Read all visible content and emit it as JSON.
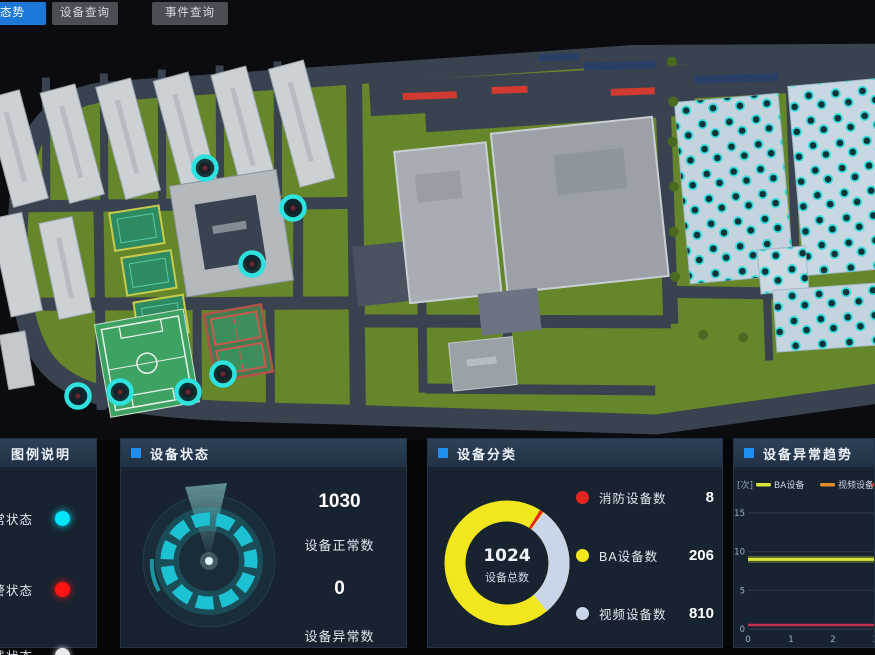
{
  "topbar": {
    "tabs": [
      {
        "label": "综合态势",
        "active": true
      },
      {
        "label": "设备查询",
        "active": false
      },
      {
        "label": "事件查询",
        "active": false
      }
    ]
  },
  "legend_panel": {
    "title": "图例说明",
    "items": [
      {
        "label": "正常状态",
        "color": "#00e6ff"
      },
      {
        "label": "报警状态",
        "color": "#ff1414"
      },
      {
        "label": "离线状态",
        "color": "#e9e9f0"
      }
    ]
  },
  "status_panel": {
    "title": "设备状态",
    "normal_value": "1030",
    "normal_label": "设备正常数",
    "abnormal_value": "0",
    "abnormal_label": "设备异常数"
  },
  "category_panel": {
    "title": "设备分类",
    "total_value": "1024",
    "total_label": "设备总数",
    "items": [
      {
        "label": "消防设备数",
        "value": "8",
        "color": "#e62420"
      },
      {
        "label": "BA设备数",
        "value": "206",
        "color": "#f2e61c"
      },
      {
        "label": "视频设备数",
        "value": "810",
        "color": "#c9d6ea"
      }
    ]
  },
  "trend_panel": {
    "title": "设备异常趋势",
    "unit_label": "[次]",
    "legend": [
      {
        "label": "BA设备",
        "color": "#d8e63a"
      },
      {
        "label": "视频设备",
        "color": "#e08a2a"
      }
    ],
    "y_ticks": [
      "15",
      "10",
      "5",
      "0"
    ],
    "x_ticks": [
      "0",
      "1",
      "2",
      "3"
    ]
  },
  "chart_data": [
    {
      "type": "pie",
      "title": "设备分类",
      "labels": [
        "消防设备数",
        "BA设备数",
        "视频设备数"
      ],
      "values": [
        8,
        206,
        810
      ],
      "colors": [
        "#e62420",
        "#f2e61c",
        "#c9d6ea"
      ],
      "center_value": 1024,
      "center_label": "设备总数",
      "legend_position": "right"
    },
    {
      "type": "line",
      "title": "设备异常趋势",
      "ylabel": "次",
      "ylim": [
        0,
        15
      ],
      "x": [
        0,
        1,
        2,
        3
      ],
      "series": [
        {
          "name": "BA设备",
          "values": [
            9,
            9,
            9,
            9
          ],
          "color": "#d8e63a"
        },
        {
          "name": "视频设备",
          "values": [
            0,
            0,
            0,
            0
          ],
          "color": "#c23350"
        }
      ],
      "grid": true,
      "legend_position": "top"
    }
  ]
}
